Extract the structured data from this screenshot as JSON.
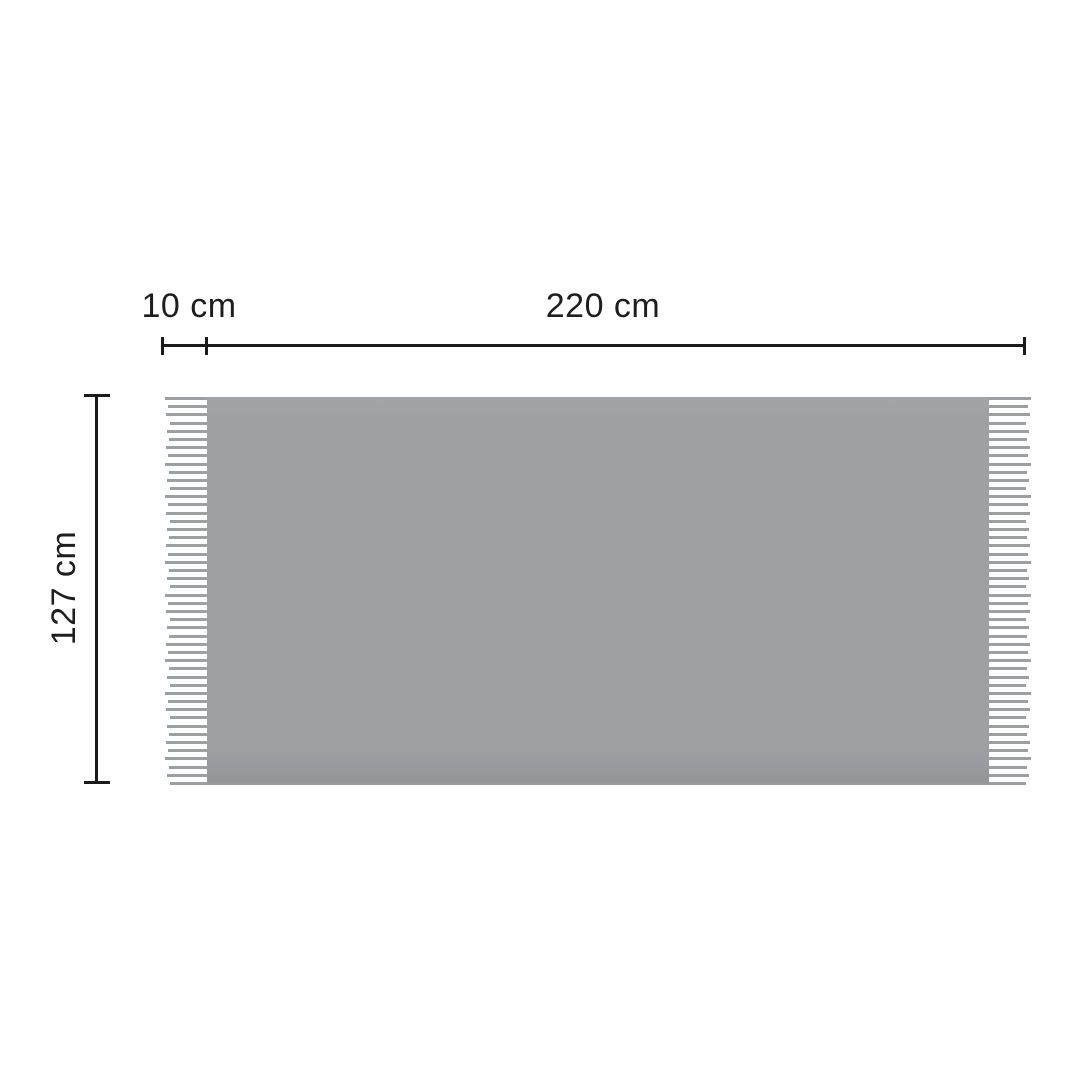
{
  "labels": {
    "fringe_width": "10 cm",
    "blanket_width": "220 cm",
    "blanket_height": "127 cm"
  },
  "colors": {
    "background": "#ffffff",
    "text": "#1e1e1e",
    "dimension_line": "#1b1b1b",
    "fabric": "#9da1a4",
    "fabric_edge_shadow": "#939699",
    "fringe_line": "#9ca0a3"
  },
  "fringe": {
    "line_count": 48,
    "line_thickness": 3
  }
}
